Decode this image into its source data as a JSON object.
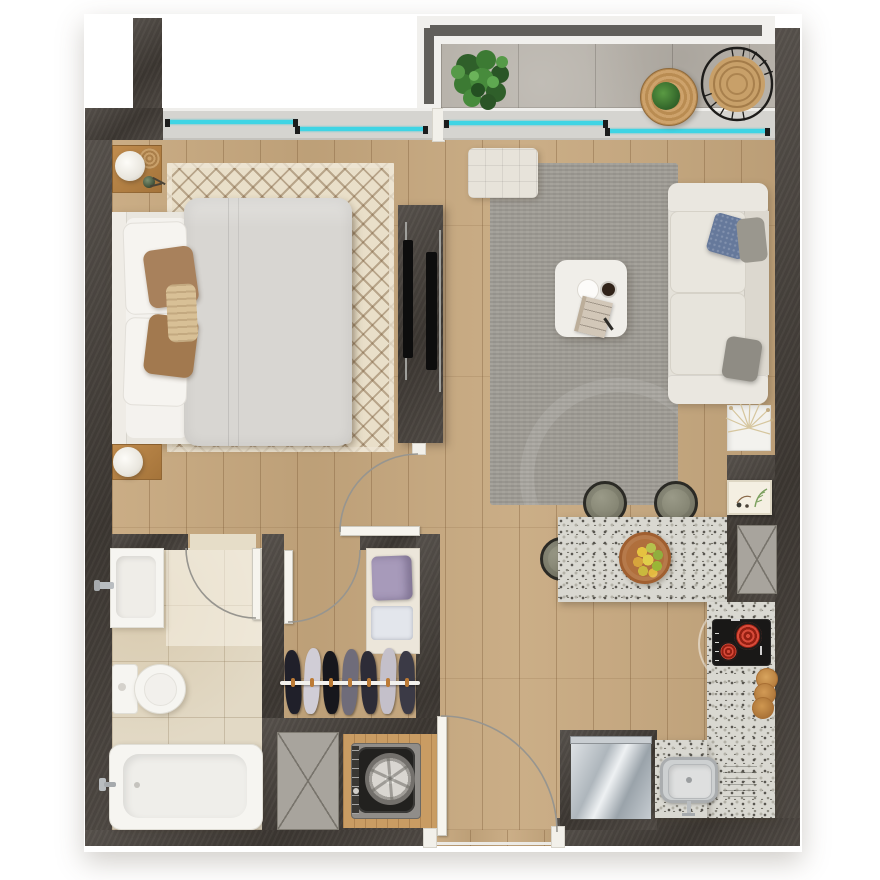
{
  "scene": {
    "type": "apartment floor plan, rendered top-down view",
    "rooms": [
      "balcony",
      "bedroom",
      "living room",
      "bathroom",
      "walk-in closet",
      "laundry nook",
      "kitchen",
      "entry hall"
    ]
  },
  "palette": {
    "wall_dark": "#46403a",
    "wall_light": "#554b41",
    "wood_floor": "#c7a87e",
    "wood_warm": "#c99c63",
    "balcony_tile": "#b7b2aa",
    "bath_tile": "#e2d9c5",
    "granite": "#d9d8d1",
    "bedroom_rug": "#e9dfc9",
    "living_rug": "#9d9a93",
    "window_glass": "#3fd4e4",
    "upholstery_cream": "#e4e1d9",
    "duvet_grey": "#d8d6d2",
    "pillow_brown": "#a8815c",
    "pillow_blue": "#66799b",
    "burner_red": "#d0402f",
    "stainless": "#b9bdc0",
    "plant_green": "#3c7a33",
    "rattan": "#c8a069",
    "shaft_grey": "#a8a49d",
    "arc_grey": "#97958f"
  },
  "inventory": [
    "double-bed",
    "bedside-lamp-x2",
    "bedroom-rug",
    "tv-media-wall",
    "balcony-plant",
    "rattan-hanging-chair",
    "balcony-side-table",
    "sliding-windows-x2",
    "sofa",
    "ottoman",
    "coffee-table",
    "living-rug",
    "dried-flower-planter",
    "kitchen-island",
    "bar-stool-x3",
    "fruit-bowl",
    "cooktop",
    "kitchen-sink",
    "refrigerator",
    "cutting-boards-x3",
    "wall-art",
    "duct-shaft-x2",
    "washing-machine",
    "wardrobe-rack",
    "closet-shelf",
    "bathtub",
    "toilet",
    "bathroom-sink",
    "door-swing-x4"
  ]
}
